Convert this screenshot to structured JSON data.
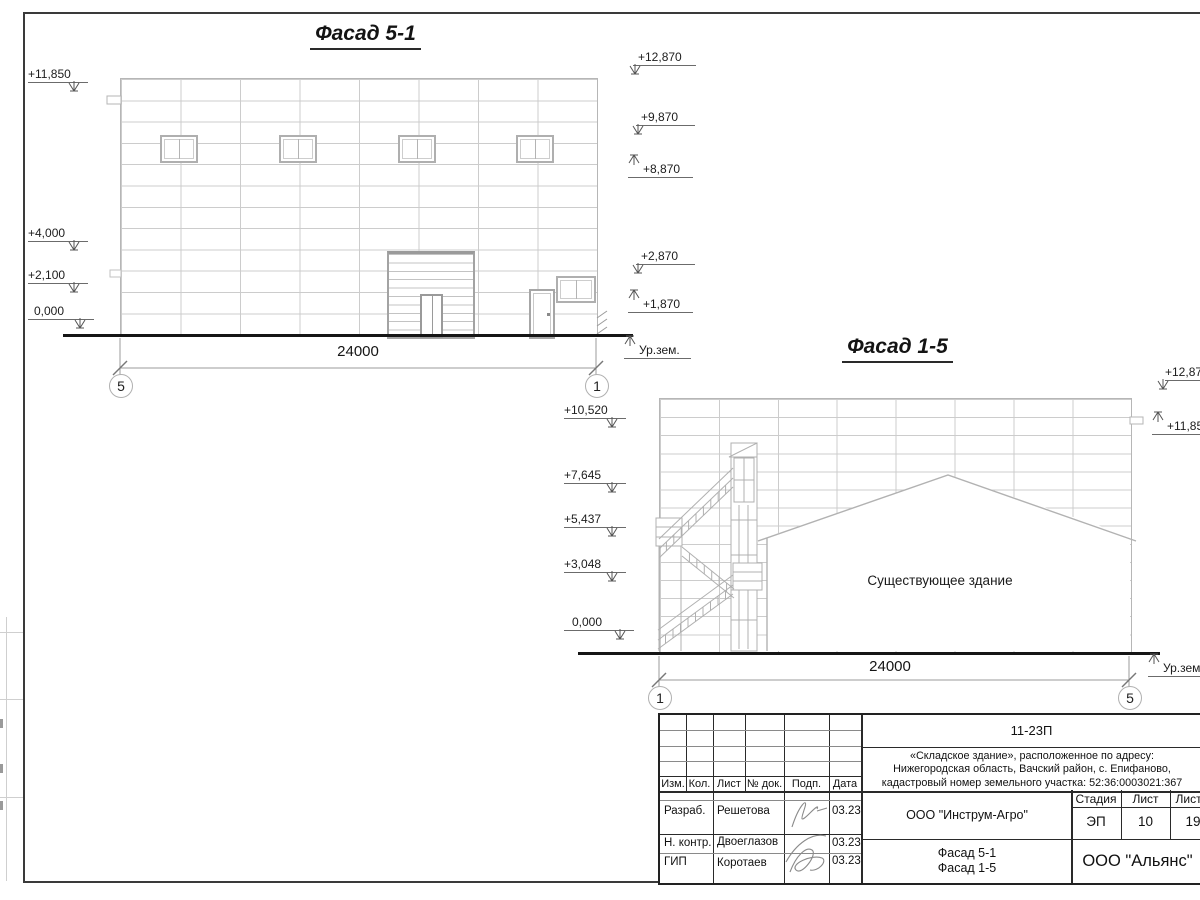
{
  "colors": {
    "ink": "#1a1a1a",
    "grid_line": "#cccccc",
    "mid_line": "#b0b0b0",
    "ground": "#151515"
  },
  "facade_5_1": {
    "title": "Фасад 5-1",
    "marks_left": [
      {
        "label": "+11,850"
      },
      {
        "label": "+4,000"
      },
      {
        "label": "+2,100"
      },
      {
        "label": "0,000"
      }
    ],
    "marks_right": [
      {
        "label": "+12,870"
      },
      {
        "label": "+9,870"
      },
      {
        "label": "+8,870"
      },
      {
        "label": "+2,870"
      },
      {
        "label": "+1,870"
      }
    ],
    "ground_label": "Ур.зем.",
    "dimension": "24000",
    "axis_left": "5",
    "axis_right": "1"
  },
  "facade_1_5": {
    "title": "Фасад 1-5",
    "marks_left": [
      {
        "label": "+10,520"
      },
      {
        "label": "+7,645"
      },
      {
        "label": "+5,437"
      },
      {
        "label": "+3,048"
      },
      {
        "label": "0,000"
      }
    ],
    "marks_right": [
      {
        "label": "+12,870"
      },
      {
        "label": "+11,850"
      }
    ],
    "existing_label": "Существующее здание",
    "ground_label": "Ур.зем.",
    "dimension": "24000",
    "axis_left": "1",
    "axis_right": "5"
  },
  "title_block": {
    "doc_number": "11-23П",
    "description_lines": [
      "«Складское здание», расположенное по адресу:",
      "Нижегородская область, Вачский район, с. Епифаново,",
      "кадастровый номер земельного участка: 52:36:0003021:367"
    ],
    "rev_headers": [
      "Изм.",
      "Кол.",
      "Лист",
      "№ док.",
      "Подп.",
      "Дата"
    ],
    "staff": [
      {
        "role": "Разраб.",
        "name": "Решетова",
        "date": "03.23"
      },
      {
        "role": "Н. контр.",
        "name": "Двоеглазов",
        "date": "03.23"
      },
      {
        "role": "ГИП",
        "name": "Коротаев",
        "date": "03.23"
      }
    ],
    "client": "ООО \"Инструм-Агро\"",
    "stage_header": "Стадия",
    "sheet_header": "Лист",
    "sheets_header": "Листов",
    "stage": "ЭП",
    "sheet_number": "10",
    "sheets_total": "19",
    "content_lines": [
      "Фасад 5-1",
      "Фасад 1-5"
    ],
    "organization": "ООО \"Альянс\""
  }
}
